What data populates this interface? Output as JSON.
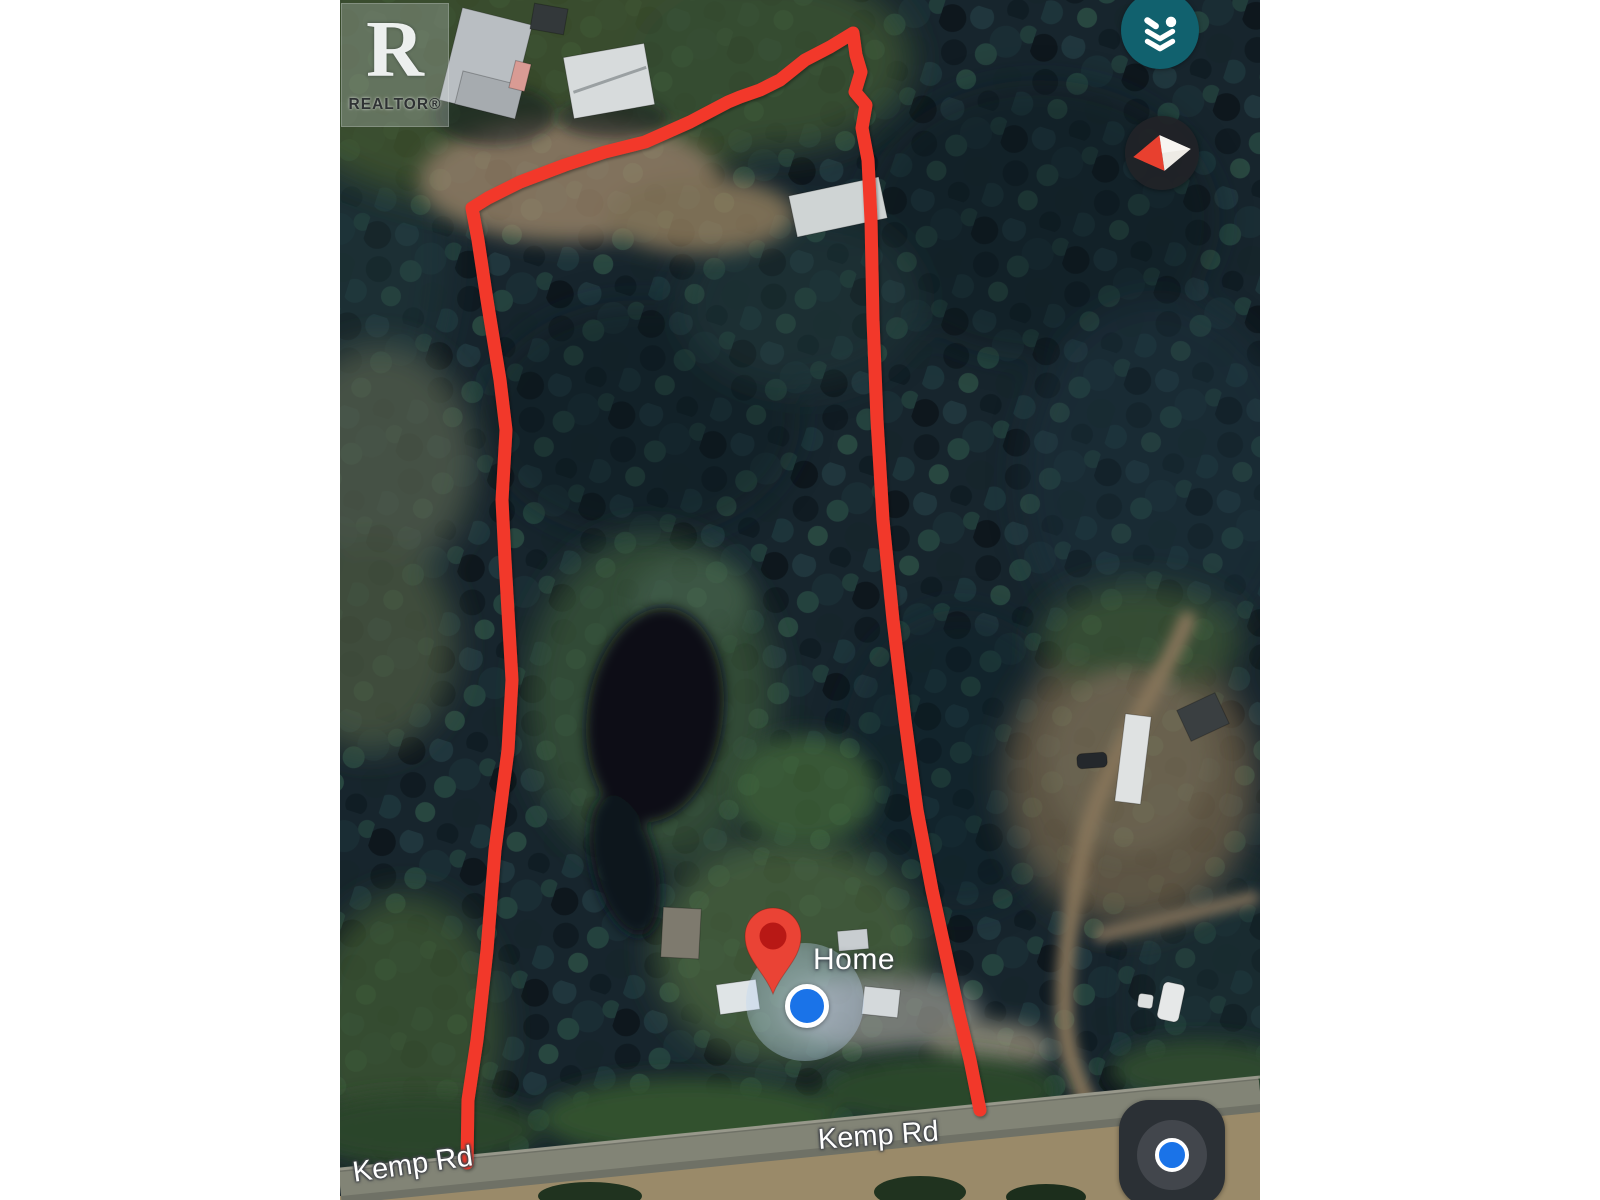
{
  "map": {
    "watermark": {
      "letter": "R",
      "text": "REALTOR®"
    },
    "marker": {
      "label": "Home",
      "pin_color": "#ea4335",
      "pin_inner": "#b31412"
    },
    "location": {
      "dot_color": "#1a73e8"
    },
    "road_labels": [
      {
        "text": "Kemp Rd"
      },
      {
        "text": "Kemp Rd"
      }
    ],
    "boundary_color": "#f2382c",
    "controls": {
      "layers_button_color": "#11616e",
      "compass_red": "#e8402f",
      "compass_white": "#eeebe5",
      "my_location_blue": "#1a73e8"
    }
  }
}
